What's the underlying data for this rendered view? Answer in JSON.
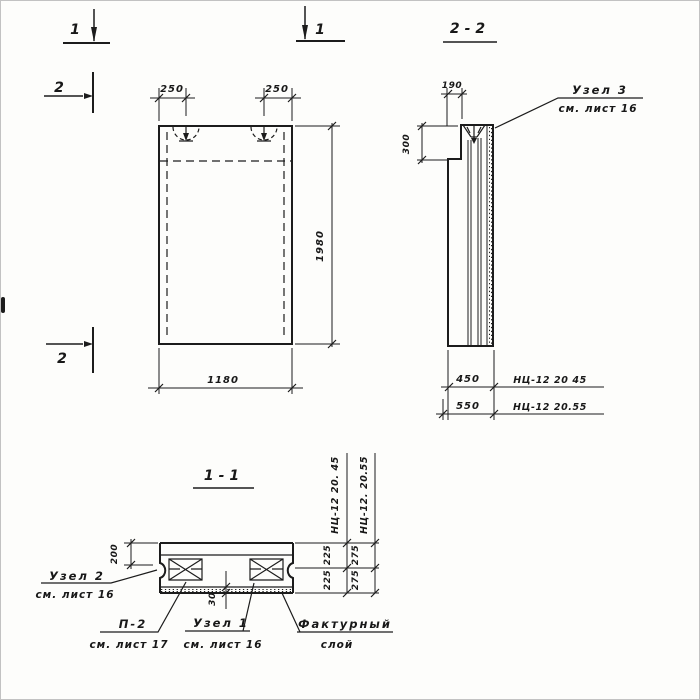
{
  "colors": {
    "ink": "#1c1c1c",
    "paper": "#fdfdfb"
  },
  "front_view": {
    "marker_1_left": "1",
    "marker_1_right": "1",
    "marker_2_top": "2",
    "marker_2_bottom": "2",
    "dim_loop_left": "250",
    "dim_loop_right": "250",
    "dim_height": "1980",
    "dim_width": "1180"
  },
  "section_2_2": {
    "title": "2-2",
    "dim_top_offset": "190",
    "dim_step_height": "300",
    "dim_width_type45": "450",
    "dim_width_type55": "550",
    "type45_label": "НЦ-12 20 45",
    "type55_label": "НЦ-12 20.55",
    "node3_callout": {
      "line1": "Узел 3",
      "line2": "см. лист 16"
    }
  },
  "section_1_1": {
    "title": "1-1",
    "dim_edge": "200",
    "dim_facing": "30",
    "type45_label": "НЦ-12 20. 45",
    "type55_label": "НЦ-12. 20.55",
    "dim45_top": "225",
    "dim45_bottom": "225",
    "dim55_top": "275",
    "dim55_bottom": "275",
    "node2_callout": {
      "line1": "Узел 2",
      "line2": "см. лист 16"
    },
    "p2_callout": {
      "line1": "П-2",
      "line2": "см. лист 17"
    },
    "node1_callout": {
      "line1": "Узел 1",
      "line2": "см. лист 16"
    },
    "facing_callout": {
      "line1": "Фактурный",
      "line2": "слой"
    }
  }
}
